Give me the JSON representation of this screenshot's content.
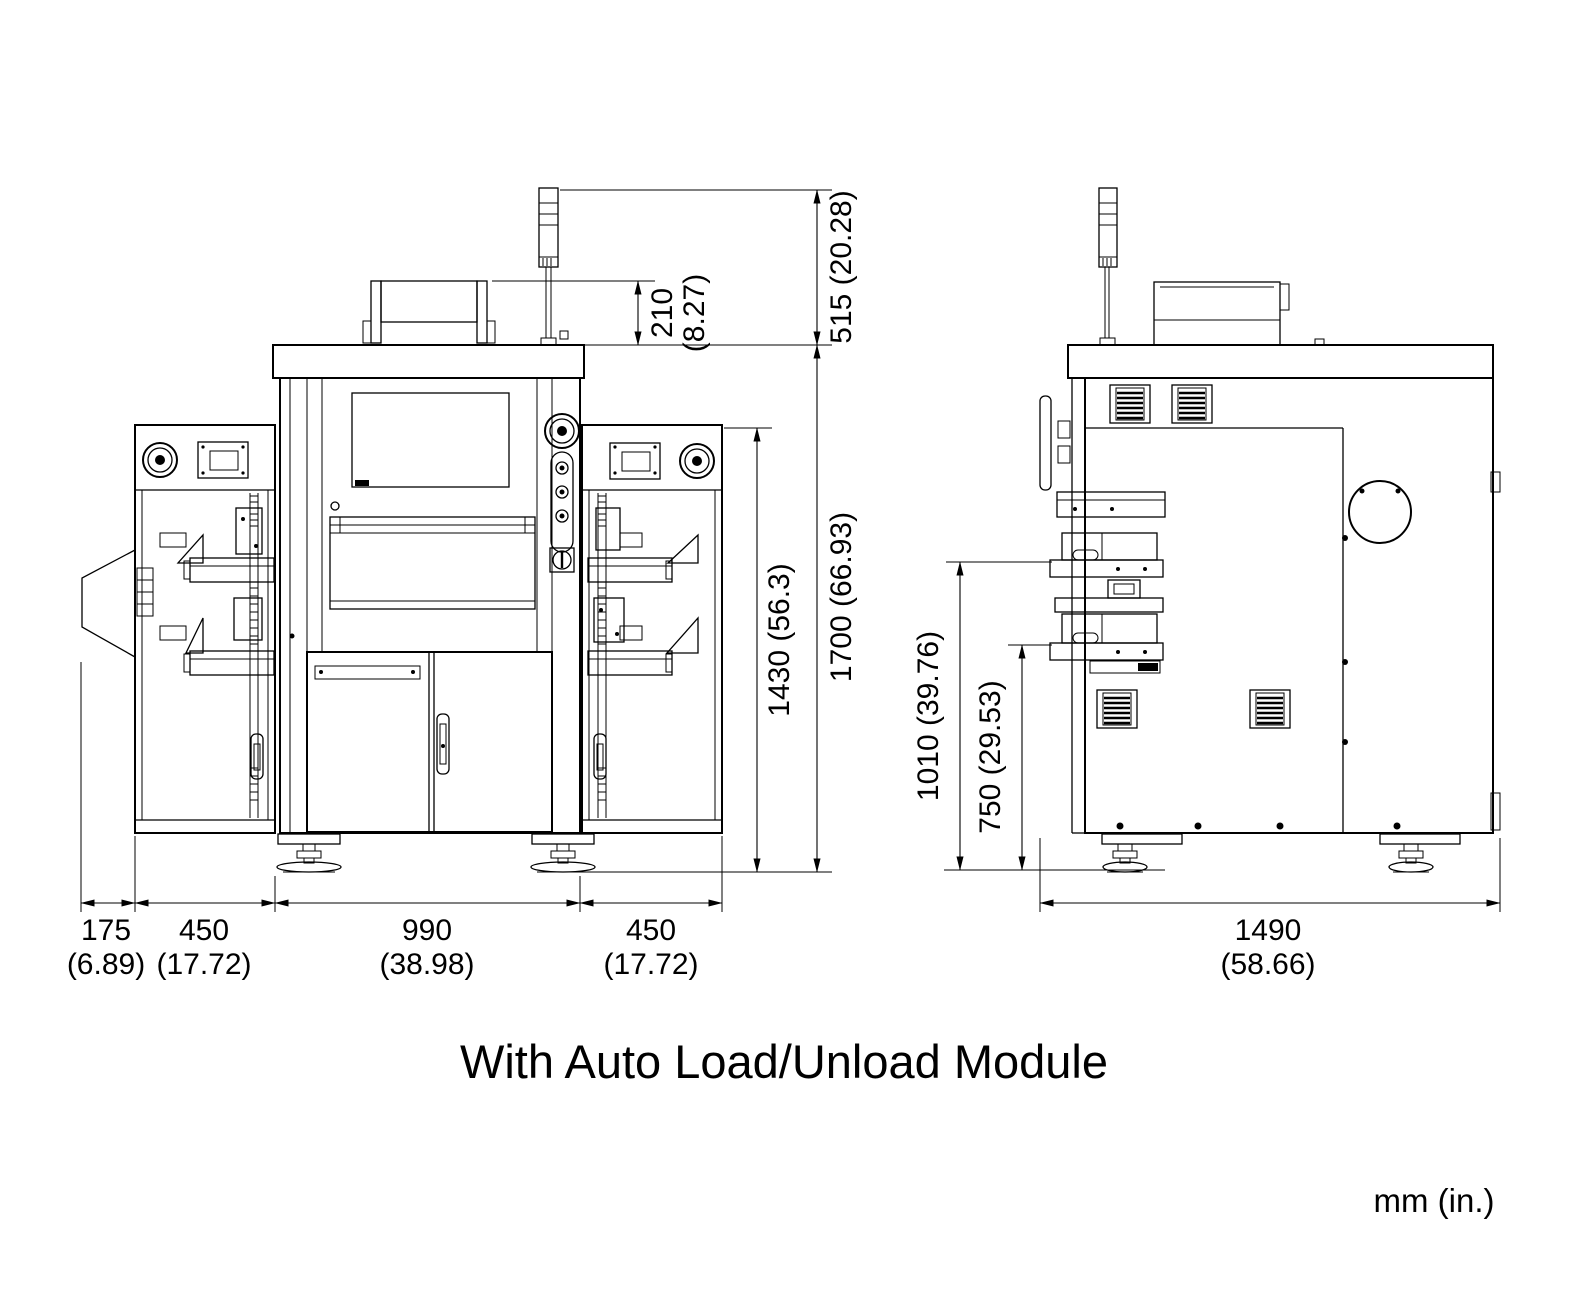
{
  "title": "With Auto Load/Unload Module",
  "units_label": "mm (in.)",
  "drawing": {
    "type": "technical-dimension-drawing",
    "views": [
      "front-view-with-load-modules",
      "side-view"
    ]
  },
  "dimensions": {
    "tower_height": {
      "mm": "515",
      "in": "(20.28)",
      "label": "515 (20.28)"
    },
    "top_box_height": {
      "mm": "210",
      "in": "(8.27)",
      "label": "210 (8.27)"
    },
    "module_height": {
      "mm": "1430",
      "in": "(56.3)",
      "label": "1430 (56.3)"
    },
    "total_height": {
      "mm": "1700",
      "in": "(66.93)",
      "label": "1700 (66.93)"
    },
    "chute_width": {
      "mm": "175",
      "in": "(6.89)",
      "label": "175 (6.89)"
    },
    "left_module_width": {
      "mm": "450",
      "in": "(17.72)",
      "label": "450 (17.72)"
    },
    "cabinet_width": {
      "mm": "990",
      "in": "(38.98)",
      "label": "990 (38.98)"
    },
    "right_module_width": {
      "mm": "450",
      "in": "(17.72)",
      "label": "450 (17.72)"
    },
    "upper_conveyor_height": {
      "mm": "1010",
      "in": "(39.76)",
      "label": "1010 (39.76)"
    },
    "lower_conveyor_height": {
      "mm": "750",
      "in": "(29.53)",
      "label": "750 (29.53)"
    },
    "machine_depth": {
      "mm": "1490",
      "in": "(58.66)",
      "label": "1490 (58.66)"
    }
  }
}
